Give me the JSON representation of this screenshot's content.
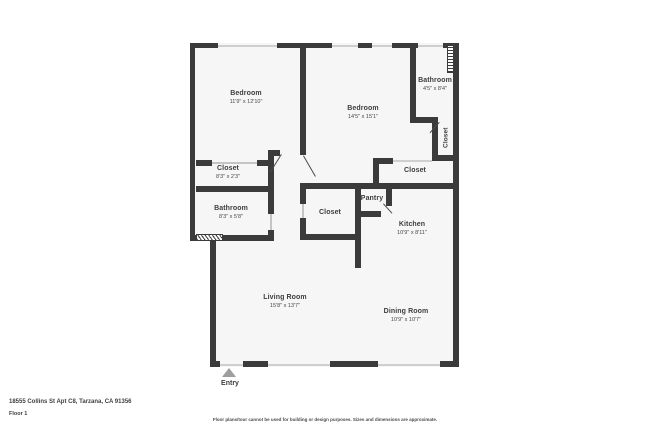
{
  "plan": {
    "rooms": [
      {
        "id": "bedroom-1",
        "name": "Bedroom",
        "dims": "11'9\" x 12'10\""
      },
      {
        "id": "bedroom-2",
        "name": "Bedroom",
        "dims": "14'5\" x 15'1\""
      },
      {
        "id": "bathroom-1",
        "name": "Bathroom",
        "dims": "4'5\" x 8'4\""
      },
      {
        "id": "closet-hall",
        "name": "Closet",
        "dims": ""
      },
      {
        "id": "closet-bed1",
        "name": "Closet",
        "dims": "8'3\" x 2'3\""
      },
      {
        "id": "bathroom-2",
        "name": "Bathroom",
        "dims": "8'3\" x 5'8\""
      },
      {
        "id": "closet-kitchen",
        "name": "Closet",
        "dims": ""
      },
      {
        "id": "closet-mid",
        "name": "Closet",
        "dims": ""
      },
      {
        "id": "pantry",
        "name": "Pantry",
        "dims": ""
      },
      {
        "id": "kitchen",
        "name": "Kitchen",
        "dims": "10'9\" x 8'11\""
      },
      {
        "id": "living-room",
        "name": "Living Room",
        "dims": "15'8\" x 13'7\""
      },
      {
        "id": "dining-room",
        "name": "Dining Room",
        "dims": "10'9\" x 10'7\""
      }
    ],
    "entry_label": "Entry"
  },
  "footer": {
    "address": "18555 Collins St Apt C8, Tarzana, CA 91356",
    "floor": "Floor 1",
    "disclaimer": "Floor plans/tour cannot be used for building or design purposes. Sizes and dimensions are approximate."
  },
  "colors": {
    "wall": "#3b3b3b",
    "room_fill": "#f6f6f6",
    "text": "#3d3d3d",
    "window_line": "#cfcfcf",
    "entry_arrow": "#9e9e9e"
  }
}
